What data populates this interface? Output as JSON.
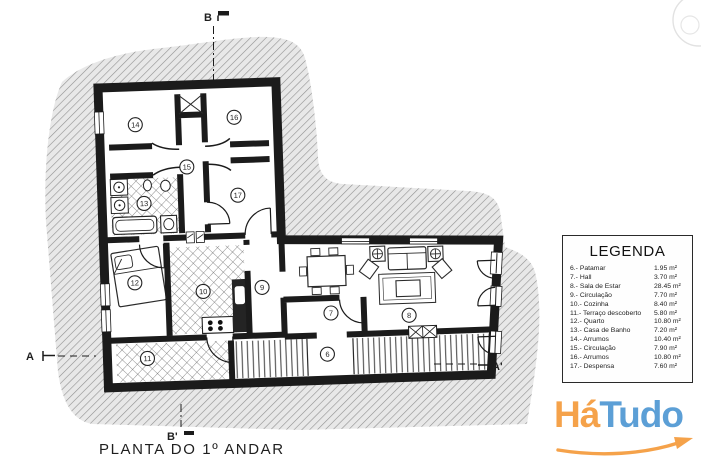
{
  "plan": {
    "title": "PLANTA DO 1º ANDAR",
    "sections": {
      "top": "B",
      "bottom": "B'",
      "left": "A",
      "right": "A'"
    },
    "rooms": {
      "r6": "6",
      "r7": "7",
      "r8": "8",
      "r9": "9",
      "r10": "10",
      "r11": "11",
      "r12": "12",
      "r13": "13",
      "r14": "14",
      "r15": "15",
      "r16": "16",
      "r17": "17"
    }
  },
  "legend": {
    "title": "LEGENDA",
    "items": [
      {
        "label": "6.- Patamar",
        "area": "1.95 m²"
      },
      {
        "label": "7.- Hall",
        "area": "3.70 m²"
      },
      {
        "label": "8.- Sala de Estar",
        "area": "28.45 m²"
      },
      {
        "label": "9.- Circulação",
        "area": "7.70 m²"
      },
      {
        "label": "10.- Cozinha",
        "area": "8.40 m²"
      },
      {
        "label": "11.- Terraço descoberto",
        "area": "5.80 m²"
      },
      {
        "label": "12.- Quarto",
        "area": "10.80 m²"
      },
      {
        "label": "13.- Casa de Banho",
        "area": "7.20 m²"
      },
      {
        "label": "14.- Arrumos",
        "area": "10.40 m²"
      },
      {
        "label": "15.- Circulação",
        "area": "7.90 m²"
      },
      {
        "label": "16.- Arrumos",
        "area": "10.80 m²"
      },
      {
        "label": "17.- Despensa",
        "area": "7.60 m²"
      }
    ]
  },
  "logo": {
    "part1": "Há",
    "part2": "Tudo",
    "color1": "#F5A24A",
    "color2": "#5C9FD6"
  }
}
